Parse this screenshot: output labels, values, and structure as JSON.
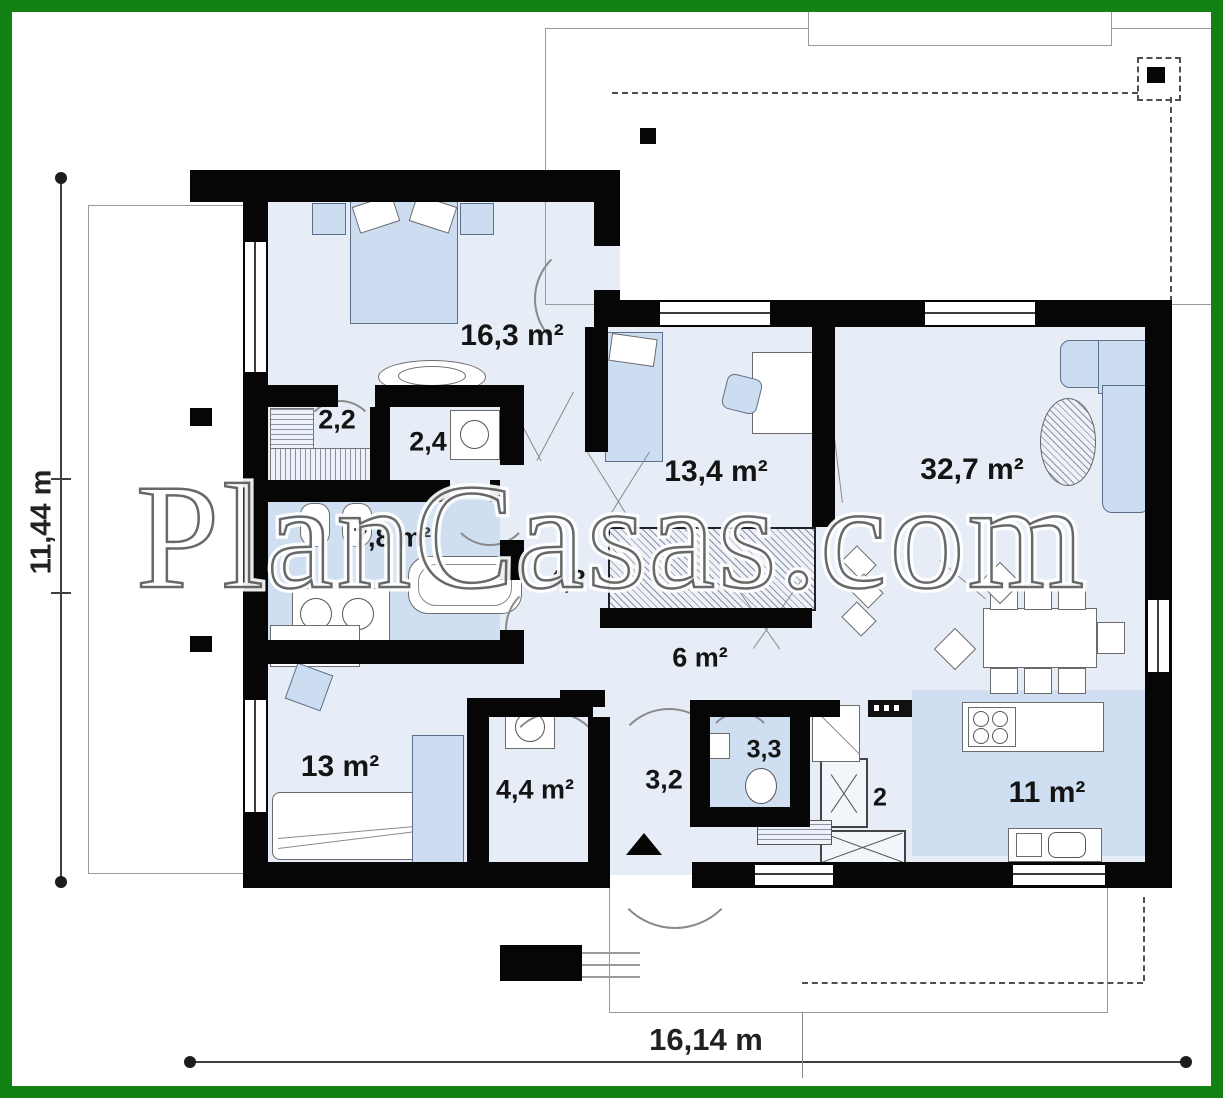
{
  "watermark": "PlanCasas.com",
  "dimensions": {
    "height": "11,44 m",
    "width": "16,14 m"
  },
  "rooms": [
    {
      "id": "bedroom-1",
      "label": "16,3 m²"
    },
    {
      "id": "wardrobe",
      "label": "2,2"
    },
    {
      "id": "toilet-small",
      "label": "2,4"
    },
    {
      "id": "bathroom",
      "label": "7,8 m²"
    },
    {
      "id": "hall-upper",
      "label": "4,8"
    },
    {
      "id": "bedroom-2",
      "label": "13,4 m²"
    },
    {
      "id": "living-room",
      "label": "32,7 m²"
    },
    {
      "id": "hall-center",
      "label": "6 m²"
    },
    {
      "id": "bedroom-3",
      "label": "13 m²"
    },
    {
      "id": "utility",
      "label": "4,4 m²"
    },
    {
      "id": "entry-hall",
      "label": "3,2"
    },
    {
      "id": "wc",
      "label": "3,3"
    },
    {
      "id": "pantry",
      "label": "2"
    },
    {
      "id": "kitchen",
      "label": "11 m²"
    }
  ],
  "colors": {
    "frame_green": "#128212",
    "wall_black": "#060606",
    "floor_light_blue": "#e6edf6",
    "floor_dark_blue": "#cfdff1",
    "watermark_gray": "#3e3e3e"
  }
}
